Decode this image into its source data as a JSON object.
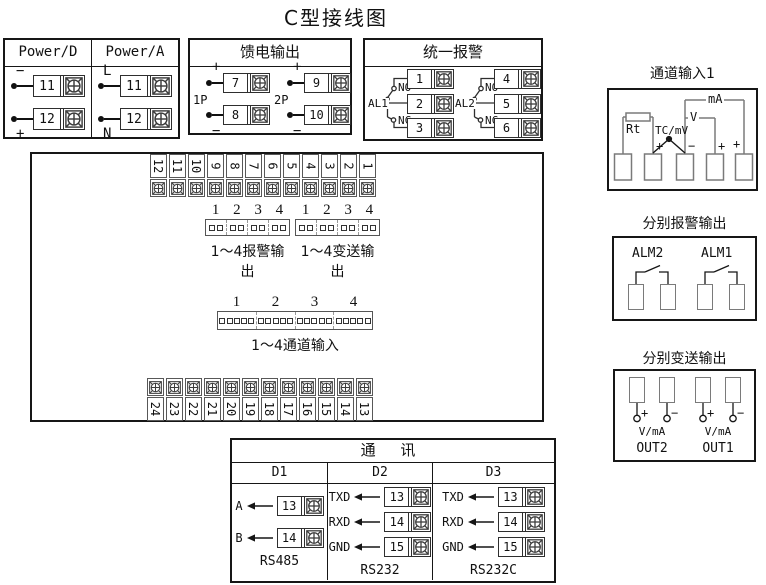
{
  "title": "C型接线图",
  "power": {
    "columns": [
      {
        "header": "Power/D",
        "rows": [
          {
            "sign": "−",
            "num": "11"
          },
          {
            "sign": "+",
            "num": "12"
          }
        ]
      },
      {
        "header": "Power/A",
        "rows": [
          {
            "sign": "L",
            "num": "11"
          },
          {
            "sign": "N",
            "num": "12"
          }
        ]
      }
    ]
  },
  "feed": {
    "title": "馈电输出",
    "groups": [
      {
        "label": "1P",
        "rows": [
          {
            "sign": "+",
            "num": "7"
          },
          {
            "sign": "−",
            "num": "8"
          }
        ]
      },
      {
        "label": "2P",
        "rows": [
          {
            "sign": "+",
            "num": "9"
          },
          {
            "sign": "−",
            "num": "10"
          }
        ]
      }
    ]
  },
  "unified_alarm": {
    "title": "统一报警",
    "relays": [
      {
        "label": "AL1",
        "no_label": "NO",
        "nc_label": "NC",
        "terminals": [
          "1",
          "2",
          "3"
        ]
      },
      {
        "label": "AL2",
        "no_label": "NO",
        "nc_label": "NC",
        "terminals": [
          "4",
          "5",
          "6"
        ]
      }
    ]
  },
  "board": {
    "top_terminals": [
      "12",
      "11",
      "10",
      "9",
      "8",
      "7",
      "6",
      "5",
      "4",
      "3",
      "2",
      "1"
    ],
    "bottom_terminals": [
      "24",
      "23",
      "22",
      "21",
      "20",
      "19",
      "18",
      "17",
      "16",
      "15",
      "14",
      "13"
    ],
    "connectors": [
      {
        "numbers": [
          "1",
          "2",
          "3",
          "4"
        ],
        "pins_per_cell": 2,
        "label": "1～4报警输出"
      },
      {
        "numbers": [
          "1",
          "2",
          "3",
          "4"
        ],
        "pins_per_cell": 2,
        "label": "1～4变送输出"
      },
      {
        "numbers": [
          "1",
          "2",
          "3",
          "4"
        ],
        "pins_per_cell": 5,
        "label": "1～4通道输入"
      }
    ]
  },
  "channel_input": {
    "title": "通道输入1",
    "rt": "Rt",
    "tc": "TC/mV",
    "v": "V",
    "ma": "mA",
    "signs": [
      "+",
      "−",
      "+",
      "+"
    ]
  },
  "alarm_output": {
    "title": "分别报警输出",
    "relays": [
      "ALM2",
      "ALM1"
    ]
  },
  "transmit_output": {
    "title": "分别变送输出",
    "plus": "+",
    "minus": "−",
    "outputs": [
      {
        "label": "OUT2",
        "unit": "V/mA"
      },
      {
        "label": "OUT1",
        "unit": "V/mA"
      }
    ]
  },
  "comm": {
    "title": "通 讯",
    "sections": [
      {
        "header": "D1",
        "standard": "RS485",
        "pins": [
          {
            "signal": "A",
            "num": "13"
          },
          {
            "signal": "B",
            "num": "14"
          }
        ]
      },
      {
        "header": "D2",
        "standard": "RS232",
        "pins": [
          {
            "signal": "TXD",
            "num": "13"
          },
          {
            "signal": "RXD",
            "num": "14"
          },
          {
            "signal": "GND",
            "num": "15"
          }
        ]
      },
      {
        "header": "D3",
        "standard": "RS232C",
        "pins": [
          {
            "signal": "TXD",
            "num": "13"
          },
          {
            "signal": "RXD",
            "num": "14"
          },
          {
            "signal": "GND",
            "num": "15"
          }
        ]
      }
    ]
  },
  "colors": {
    "line": "#161616",
    "gray_line": "#7a7a7a",
    "bg": "#ffffff"
  }
}
